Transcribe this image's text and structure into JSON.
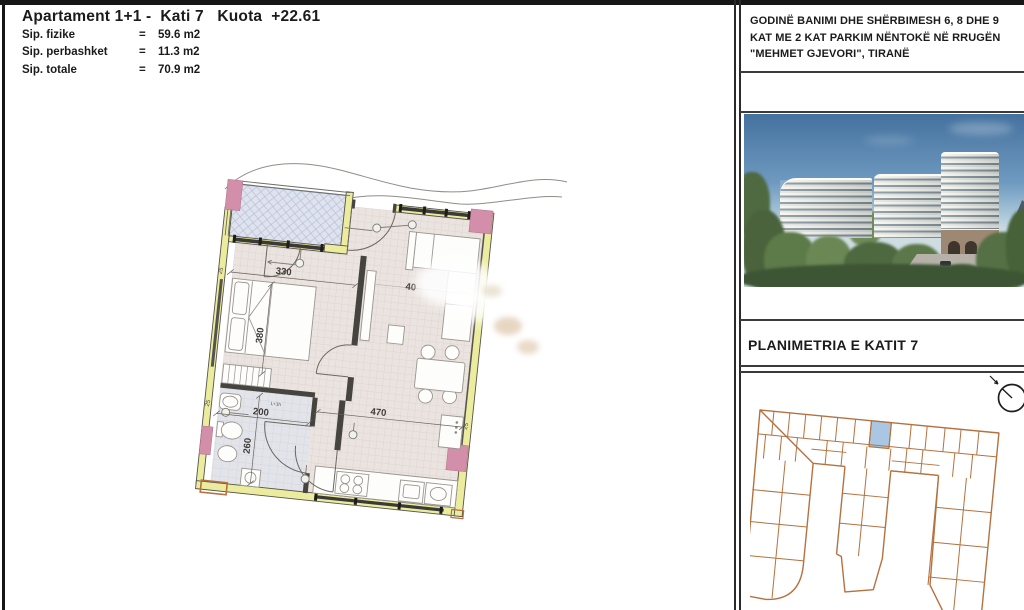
{
  "title_block": {
    "title": "Apartament 1+1 -  Kati 7   Kuota  +22.61",
    "rows": [
      {
        "label": "Sip. fizike",
        "eq": "=",
        "value": "59.6 m2"
      },
      {
        "label": "Sip. perbashket",
        "eq": "=",
        "value": "11.3 m2"
      },
      {
        "label": "Sip. totale",
        "eq": "=",
        "value": "70.9 m2"
      }
    ]
  },
  "floor_plan": {
    "dims": {
      "bedroom_width": "330",
      "bedroom_depth": "380",
      "bath_width": "200",
      "bath_depth": "260",
      "living_width": "470",
      "partial": "40",
      "wall_thickness": "25",
      "note": "L+1h"
    }
  },
  "right_panel": {
    "project_title_line1": "GODINË BANIMI DHE SHËRBIMESH 6, 8 DHE 9",
    "project_title_line2": "KAT ME 2 KAT PARKIM NËNTOKË NË RRUGËN",
    "project_title_line3": "\"MEHMET GJEVORI\", TIRANË",
    "section_title": "PLANIMETRIA E KATIT 7",
    "render_caption": "building-render",
    "north_icon": "north-arrow-icon"
  },
  "colors": {
    "wall_yellow": "#ecec9f",
    "column_pink": "#d38fa9",
    "balcony_blue": "#e0e3ee",
    "keyplan_orange": "#b5713f",
    "unit_highlight_blue": "#a9c7e2",
    "sky_blue": "#44719e"
  }
}
